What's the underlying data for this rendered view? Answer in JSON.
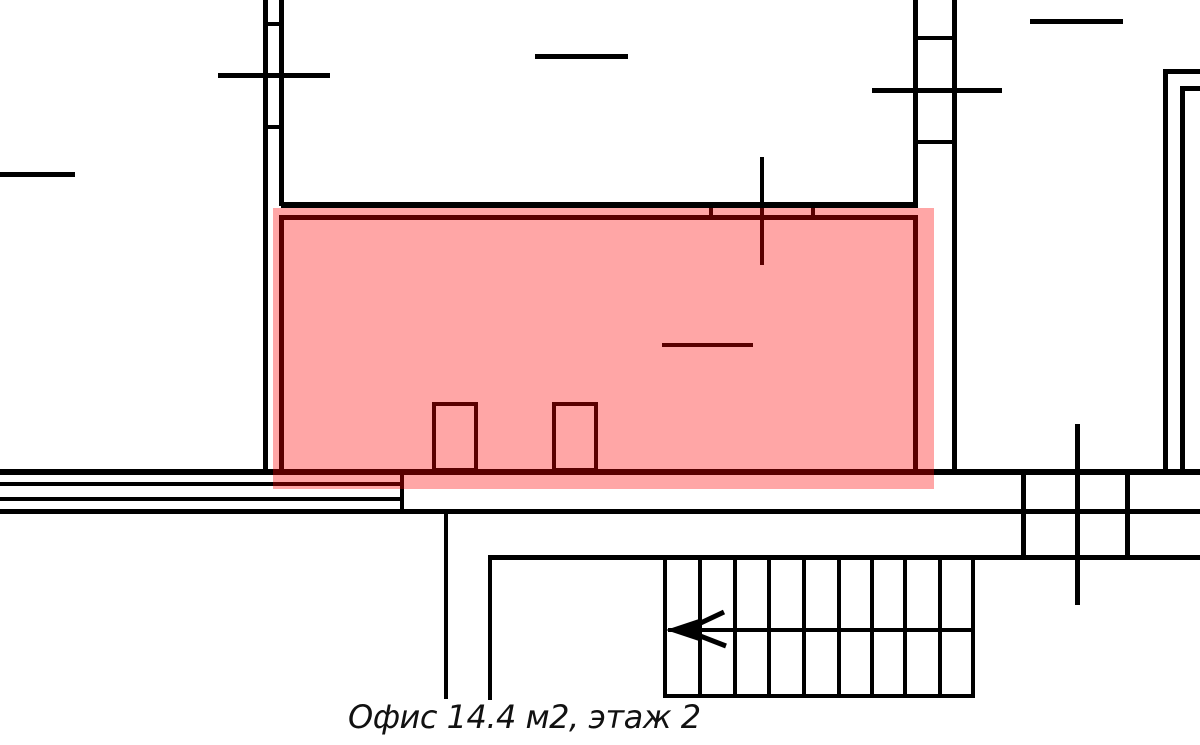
{
  "caption": {
    "text": "Офис 14.4 м2, этаж 2"
  },
  "colors": {
    "line": "#000000",
    "highlight_fill": "rgba(255,0,0,0.35)",
    "background": "#ffffff",
    "caption_text": "#111111"
  },
  "office": {
    "label": "Офис",
    "area_m2": "14.4",
    "floor": "2"
  },
  "floorplan": {
    "highlight": {
      "name": "office-highlight",
      "x": 273,
      "y": 208,
      "w": 661,
      "h": 281
    },
    "segments": [
      {
        "name": "left-wall-outer",
        "x": 263,
        "y": 0,
        "w": 5,
        "h": 474
      },
      {
        "name": "left-wall-inner",
        "x": 279,
        "y": 0,
        "w": 5,
        "h": 206
      },
      {
        "name": "left-wall-tick-top",
        "x": 263,
        "y": 22,
        "w": 21,
        "h": 4
      },
      {
        "name": "left-wall-tick-bottom",
        "x": 263,
        "y": 125,
        "w": 21,
        "h": 4
      },
      {
        "name": "left-window-marker",
        "x": 218,
        "y": 73,
        "w": 112,
        "h": 5
      },
      {
        "name": "far-left-wall-segment",
        "x": 0,
        "y": 172,
        "w": 75,
        "h": 5
      },
      {
        "name": "top-middle-wall-segment",
        "x": 535,
        "y": 54,
        "w": 93,
        "h": 5
      },
      {
        "name": "right-column-wall-left",
        "x": 913,
        "y": 0,
        "w": 5,
        "h": 206
      },
      {
        "name": "right-column-wall-right",
        "x": 952,
        "y": 0,
        "w": 5,
        "h": 473
      },
      {
        "name": "right-column-tick-top",
        "x": 913,
        "y": 36,
        "w": 44,
        "h": 4
      },
      {
        "name": "right-column-tick-bottom",
        "x": 913,
        "y": 140,
        "w": 44,
        "h": 4
      },
      {
        "name": "right-window-marker",
        "x": 872,
        "y": 88,
        "w": 130,
        "h": 5
      },
      {
        "name": "top-right-wall-segment",
        "x": 1030,
        "y": 19,
        "w": 93,
        "h": 5
      },
      {
        "name": "topright-corner-outer-v",
        "x": 1163,
        "y": 69,
        "w": 5,
        "h": 403
      },
      {
        "name": "topright-corner-outer-h",
        "x": 1163,
        "y": 69,
        "w": 37,
        "h": 5
      },
      {
        "name": "topright-corner-inner-v",
        "x": 1180,
        "y": 86,
        "w": 5,
        "h": 386
      },
      {
        "name": "topright-corner-inner-h",
        "x": 1180,
        "y": 86,
        "w": 20,
        "h": 5
      },
      {
        "name": "office-top-outer-wall",
        "x": 281,
        "y": 202,
        "w": 637,
        "h": 6
      },
      {
        "name": "office-door-jamb-left",
        "x": 709,
        "y": 202,
        "w": 4,
        "h": 18
      },
      {
        "name": "office-door-jamb-right",
        "x": 811,
        "y": 202,
        "w": 4,
        "h": 18
      },
      {
        "name": "office-window-marker-vertical",
        "x": 760,
        "y": 157,
        "w": 4,
        "h": 108
      },
      {
        "name": "office-window-sill",
        "x": 662,
        "y": 343,
        "w": 91,
        "h": 4
      },
      {
        "name": "corridor-wall-1",
        "x": 0,
        "y": 469,
        "w": 1200,
        "h": 6
      },
      {
        "name": "corridor-wall-2",
        "x": 0,
        "y": 482,
        "w": 404,
        "h": 4
      },
      {
        "name": "corridor-wall-3",
        "x": 0,
        "y": 497,
        "w": 404,
        "h": 4
      },
      {
        "name": "corridor-wall-4",
        "x": 0,
        "y": 509,
        "w": 1200,
        "h": 5
      },
      {
        "name": "corridor-door-jamb",
        "x": 400,
        "y": 469,
        "w": 4,
        "h": 45
      },
      {
        "name": "lower-partition-wall",
        "x": 444,
        "y": 509,
        "w": 4,
        "h": 190
      },
      {
        "name": "stairwell-left-wall",
        "x": 488,
        "y": 555,
        "w": 4,
        "h": 145
      },
      {
        "name": "stairwell-top-wall",
        "x": 488,
        "y": 555,
        "w": 712,
        "h": 5
      },
      {
        "name": "stair-tread-1",
        "x": 663,
        "y": 557,
        "w": 4,
        "h": 140
      },
      {
        "name": "stair-tread-2",
        "x": 698,
        "y": 557,
        "w": 4,
        "h": 140
      },
      {
        "name": "stair-tread-3",
        "x": 733,
        "y": 557,
        "w": 4,
        "h": 140
      },
      {
        "name": "stair-tread-4",
        "x": 767,
        "y": 557,
        "w": 4,
        "h": 140
      },
      {
        "name": "stair-tread-5",
        "x": 802,
        "y": 557,
        "w": 4,
        "h": 140
      },
      {
        "name": "stair-tread-6",
        "x": 837,
        "y": 557,
        "w": 4,
        "h": 140
      },
      {
        "name": "stair-tread-7",
        "x": 870,
        "y": 557,
        "w": 4,
        "h": 140
      },
      {
        "name": "stair-tread-8",
        "x": 903,
        "y": 557,
        "w": 4,
        "h": 140
      },
      {
        "name": "stair-tread-9",
        "x": 938,
        "y": 557,
        "w": 4,
        "h": 140
      },
      {
        "name": "stair-tread-10",
        "x": 971,
        "y": 557,
        "w": 4,
        "h": 140
      },
      {
        "name": "stair-landing-line",
        "x": 668,
        "y": 628,
        "w": 305,
        "h": 4
      },
      {
        "name": "stairwell-bottom-wall",
        "x": 663,
        "y": 694,
        "w": 312,
        "h": 4
      },
      {
        "name": "shaft-wall-left",
        "x": 1021,
        "y": 469,
        "w": 5,
        "h": 91
      },
      {
        "name": "shaft-wall-middle",
        "x": 1075,
        "y": 424,
        "w": 5,
        "h": 181
      },
      {
        "name": "shaft-wall-right",
        "x": 1125,
        "y": 469,
        "w": 5,
        "h": 91
      }
    ],
    "outlines": [
      {
        "name": "office-room-border",
        "x": 279,
        "y": 215,
        "w": 639,
        "h": 260,
        "t": 5
      },
      {
        "name": "office-door-leaf-1",
        "x": 432,
        "y": 402,
        "w": 46,
        "h": 70,
        "t": 4
      },
      {
        "name": "office-door-leaf-2",
        "x": 552,
        "y": 402,
        "w": 46,
        "h": 70,
        "t": 4
      }
    ],
    "stair_arrow": {
      "head_points": "666,630 699,619 699,641",
      "tail_up": {
        "x1": 690,
        "y1": 628,
        "x2": 724,
        "y2": 612
      },
      "tail_down": {
        "x1": 690,
        "y1": 632,
        "x2": 726,
        "y2": 646
      },
      "stroke_width": 5
    }
  }
}
